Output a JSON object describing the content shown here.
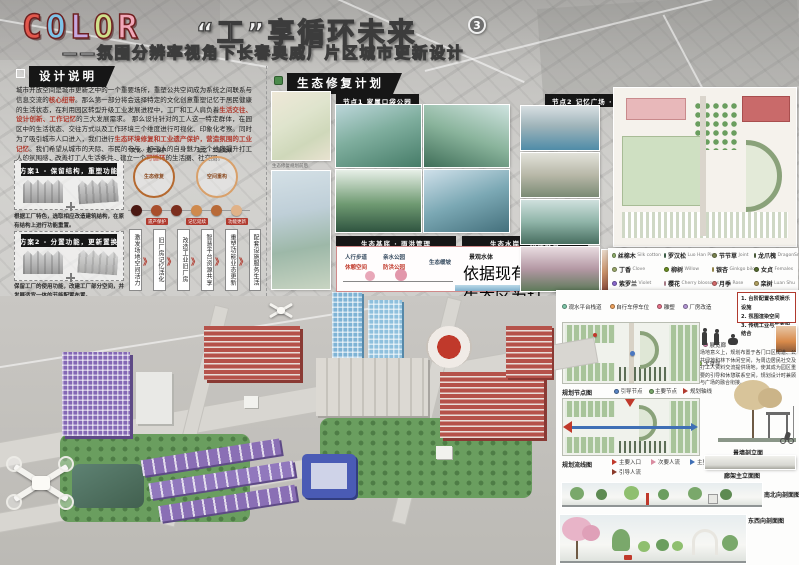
{
  "header": {
    "letters": [
      {
        "ch": "C",
        "color": "#e2574c"
      },
      {
        "ch": "O",
        "color": "#7ec3e8"
      },
      {
        "ch": "L",
        "color": "#c7a8e0"
      },
      {
        "ch": "O",
        "color": "#cfe08a"
      },
      {
        "ch": "R",
        "color": "#f0a7b8"
      }
    ],
    "title_cn": "“工”享循环未来",
    "badge": "3",
    "subtitle": "——氛围分辨率视角下长春奥威厂片区城市更新设计"
  },
  "design_note": {
    "header": "设计说明",
    "p1a": "城市开放空间是城市更新之中的一个重要场所，重塑公共空间成为系统之间联系与信息交流的",
    "p1b": "核心纽带",
    "p1c": "。那么第一部分将会选择特定的文化创意重塑记忆于居民健康的生活状态，在利用园区转型升级工业发展进程中，工厂和工人肩负着",
    "p1d": "生活交往、设计创新、工作记忆",
    "p1e": "的三大发展需求。",
    "p2a": "那么设计针对的工人这一特定群体，在园区中的生活状态、交往方式以及工作环境三个维度进行可视化、印象化考察。同时为了吸引城市人口进入，我们进行",
    "p2b": "生态环境修复和工业遗产保护，营造氛围的工业记忆",
    "p2c": "。我们希望从城市的天际、市民的参与、打工人的自身魅力三个维度提升打工人的氛围感，改善打工人生活条件，建立一个",
    "p2d": "可循环",
    "p2e": "的生活圈、社交圈。"
  },
  "plans": {
    "p1_title": "方案1 - 保留结构，重塑功能",
    "p1_text": "根据工厂特色，选取相应改造建筑结构，在原有结构上进行功能重置。",
    "p2_title": "方案2 - 分置功能，更新置换",
    "p2_text": "保留工厂的使用功能，改建工厂部分空间，并发展适宜一体的节能配置布置。"
  },
  "diagram": {
    "cycle1_label": "文化 · 遗产保护",
    "cycle2_label": "记忆 · 工业延续",
    "cycle1_inner": "生态修复",
    "cycle2_inner": "空间重构",
    "dot_colors": [
      "#4a1812",
      "#a84e2c",
      "#7c2f1e",
      "#cf8a4e",
      "#b86a38",
      "#e0b288"
    ],
    "dot_tags": [
      "遗产保护",
      "记忆延续",
      "功能更新"
    ],
    "strips": [
      "激发场地空间活力",
      "旧厂房记忆活化",
      "改造工业旧厂房",
      "智慧平台资源共享",
      "重塑功能业态更新",
      "配套设施服务生活"
    ],
    "chevron": "》"
  },
  "eco": {
    "header": "生态修复计划",
    "maps_caption": "生态修复规划前后",
    "node1": "节点1 家属口袋公园",
    "node2": "节点2 记忆广场 · 气象公园",
    "bar1": "生态基底 · 雨洪管理",
    "bar2": "生态水岸 · 水质改善",
    "labels": [
      "人行步道",
      "休憩空间",
      "亲水公园",
      "防洪公园",
      "生态缓坡"
    ],
    "water_title": "景观水体",
    "para": "依据现有的生态区为打工人打造口袋公园，以滨水廊道空间进行打造改造，建设和完善生态走廊道，为打工人营造自然且惬意的生态休憩空间。"
  },
  "plants": [
    {
      "cn": "丝棉木",
      "en": "Silk cotton",
      "color": "#8fae6b"
    },
    {
      "cn": "罗汉松",
      "en": "Luo Han Pine",
      "color": "#4a7c59"
    },
    {
      "cn": "节节草",
      "en": "Joint",
      "color": "#7a8450"
    },
    {
      "cn": "龙爪槐",
      "en": "DragonSnatch",
      "color": "#5b7444"
    },
    {
      "cn": "丁香",
      "en": "Clove",
      "color": "#9aa86b"
    },
    {
      "cn": "柳树",
      "en": "Willow",
      "color": "#6b8e23"
    },
    {
      "cn": "银杏",
      "en": "Ginkgo bilo",
      "color": "#c9b458"
    },
    {
      "cn": "女贞",
      "en": "Females",
      "color": "#556b2f"
    },
    {
      "cn": "紫罗兰",
      "en": "Violet",
      "color": "#8968cd"
    },
    {
      "cn": "樱花",
      "en": "Cherry blossoms",
      "color": "#e8a7b8"
    },
    {
      "cn": "月季",
      "en": "Rose",
      "color": "#d46a6a"
    },
    {
      "cn": "栾树",
      "en": "Luan Shu",
      "color": "#b0a060"
    },
    {
      "cn": "大叶杨",
      "en": "Populus euphratica",
      "color": "#7d9b64"
    }
  ],
  "right_panel": {
    "legend_items": [
      {
        "label": "观水平台栈道",
        "color": "#7ec8a9"
      },
      {
        "label": "自行车停车位",
        "color": "#f0a35e"
      },
      {
        "label": "雕塑",
        "color": "#e8738a"
      },
      {
        "label": "厂房改造",
        "color": "#b497d6"
      },
      {
        "label": "林下书屋",
        "color": "#8fbf6f"
      },
      {
        "label": "湿地竹林",
        "color": "#5aa469"
      },
      {
        "label": "朝阳广场",
        "color": "#e4b04a"
      },
      {
        "label": "记忆之门",
        "color": "#d96459"
      },
      {
        "label": "雨水花园",
        "color": "#6fb7d9"
      },
      {
        "label": "百年小屋",
        "color": "#c98f5e"
      },
      {
        "label": "廊架",
        "color": "#a3b86c"
      },
      {
        "label": "舞蹈林荫道",
        "color": "#7fa86b"
      },
      {
        "label": "展览廊",
        "color": "#d98cb3"
      },
      {
        "label": "阅读广场",
        "color": "#e2c275"
      },
      {
        "label": "气象站",
        "color": "#6f9fd8"
      },
      {
        "label": "纪念碑",
        "color": "#b5651d"
      },
      {
        "label": "林下休闲",
        "color": "#6b8e23"
      },
      {
        "label": "大草坪",
        "color": "#9ccc65"
      }
    ],
    "notes": [
      "1. 台阶配置各项娱乐设施",
      "2. 氛围渲染空间",
      "3. 传统工业与生态相结合"
    ],
    "para": "场地意义上，规划布置于各门口区街道、公共绿地和林下休闲空间，为周边居民社交及打工人资料交流提供场地，使其成为园区重要的引导和休憩联系空间，规划设计时兼顾与广场的融合衔接。",
    "plan_node_label": "规划节点图",
    "node_legend": [
      "引导节点",
      "主要节点",
      "规划轴线"
    ],
    "plan_flow_label": "规划流线图",
    "flow_legend": [
      "主要入口",
      "次要人流",
      "主要人流",
      "引导人流"
    ],
    "wall_section": "景墙剖立面",
    "gallery_elev": "廊架主立面图",
    "section_ns": "南北向剖面图",
    "section_ew": "东西向剖面图"
  }
}
